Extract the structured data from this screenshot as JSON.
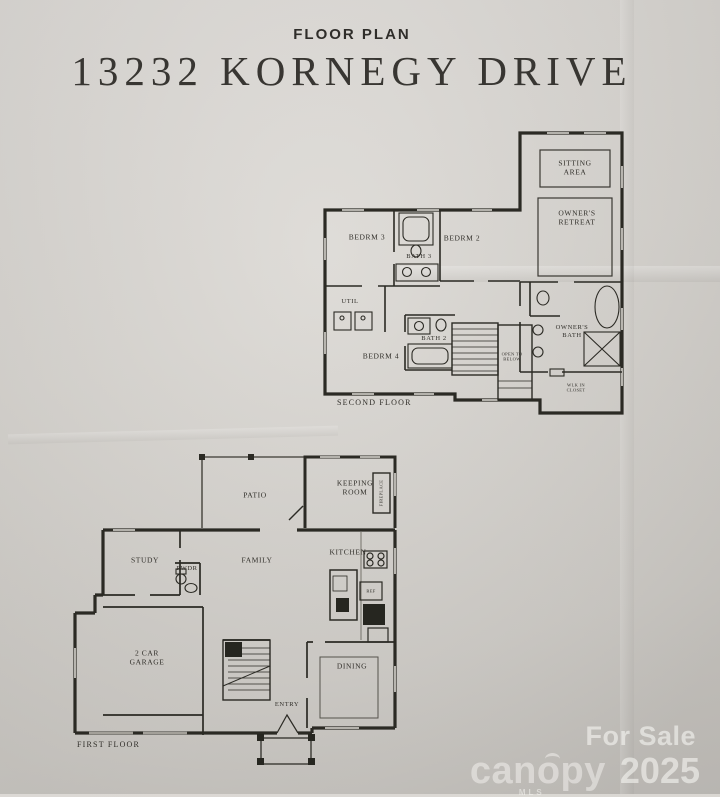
{
  "page": {
    "kicker": "FLOOR PLAN",
    "title": "13232 KORNEGY DRIVE"
  },
  "second_floor": {
    "floor_label": "SECOND FLOOR",
    "rooms": {
      "sitting_area": "SITTING\nAREA",
      "owners_retreat": "OWNER'S\nRETREAT",
      "bedrm_3": "BEDRM 3",
      "bedrm_2": "BEDRM 2",
      "bath_3": "BATH 3",
      "util": "UTIL",
      "bedrm_4": "BEDRM 4",
      "bath_2": "BATH 2",
      "owners_bath": "OWNER'S\nBATH",
      "open_to_below": "OPEN TO\nBELOW",
      "wlk_in_closet": "WLK IN\nCLOSET"
    }
  },
  "first_floor": {
    "floor_label": "FIRST FLOOR",
    "rooms": {
      "patio": "PATIO",
      "keeping_room": "KEEPING\nROOM",
      "fireplace": "FIREPLACE",
      "study": "STUDY",
      "pwdr": "PWDR",
      "family": "FAMILY",
      "kitchen": "KITCHEN",
      "ref": "REF",
      "garage": "2 CAR\nGARAGE",
      "entry": "ENTRY",
      "dining": "DINING"
    }
  },
  "watermark": {
    "for_sale": "For Sale",
    "brand": "canopy",
    "brand_sub": "MLS",
    "year": "2025"
  },
  "colors": {
    "paper": "#d7d4cf",
    "ink": "#2b2a24",
    "watermark": "#fcfbf8"
  }
}
